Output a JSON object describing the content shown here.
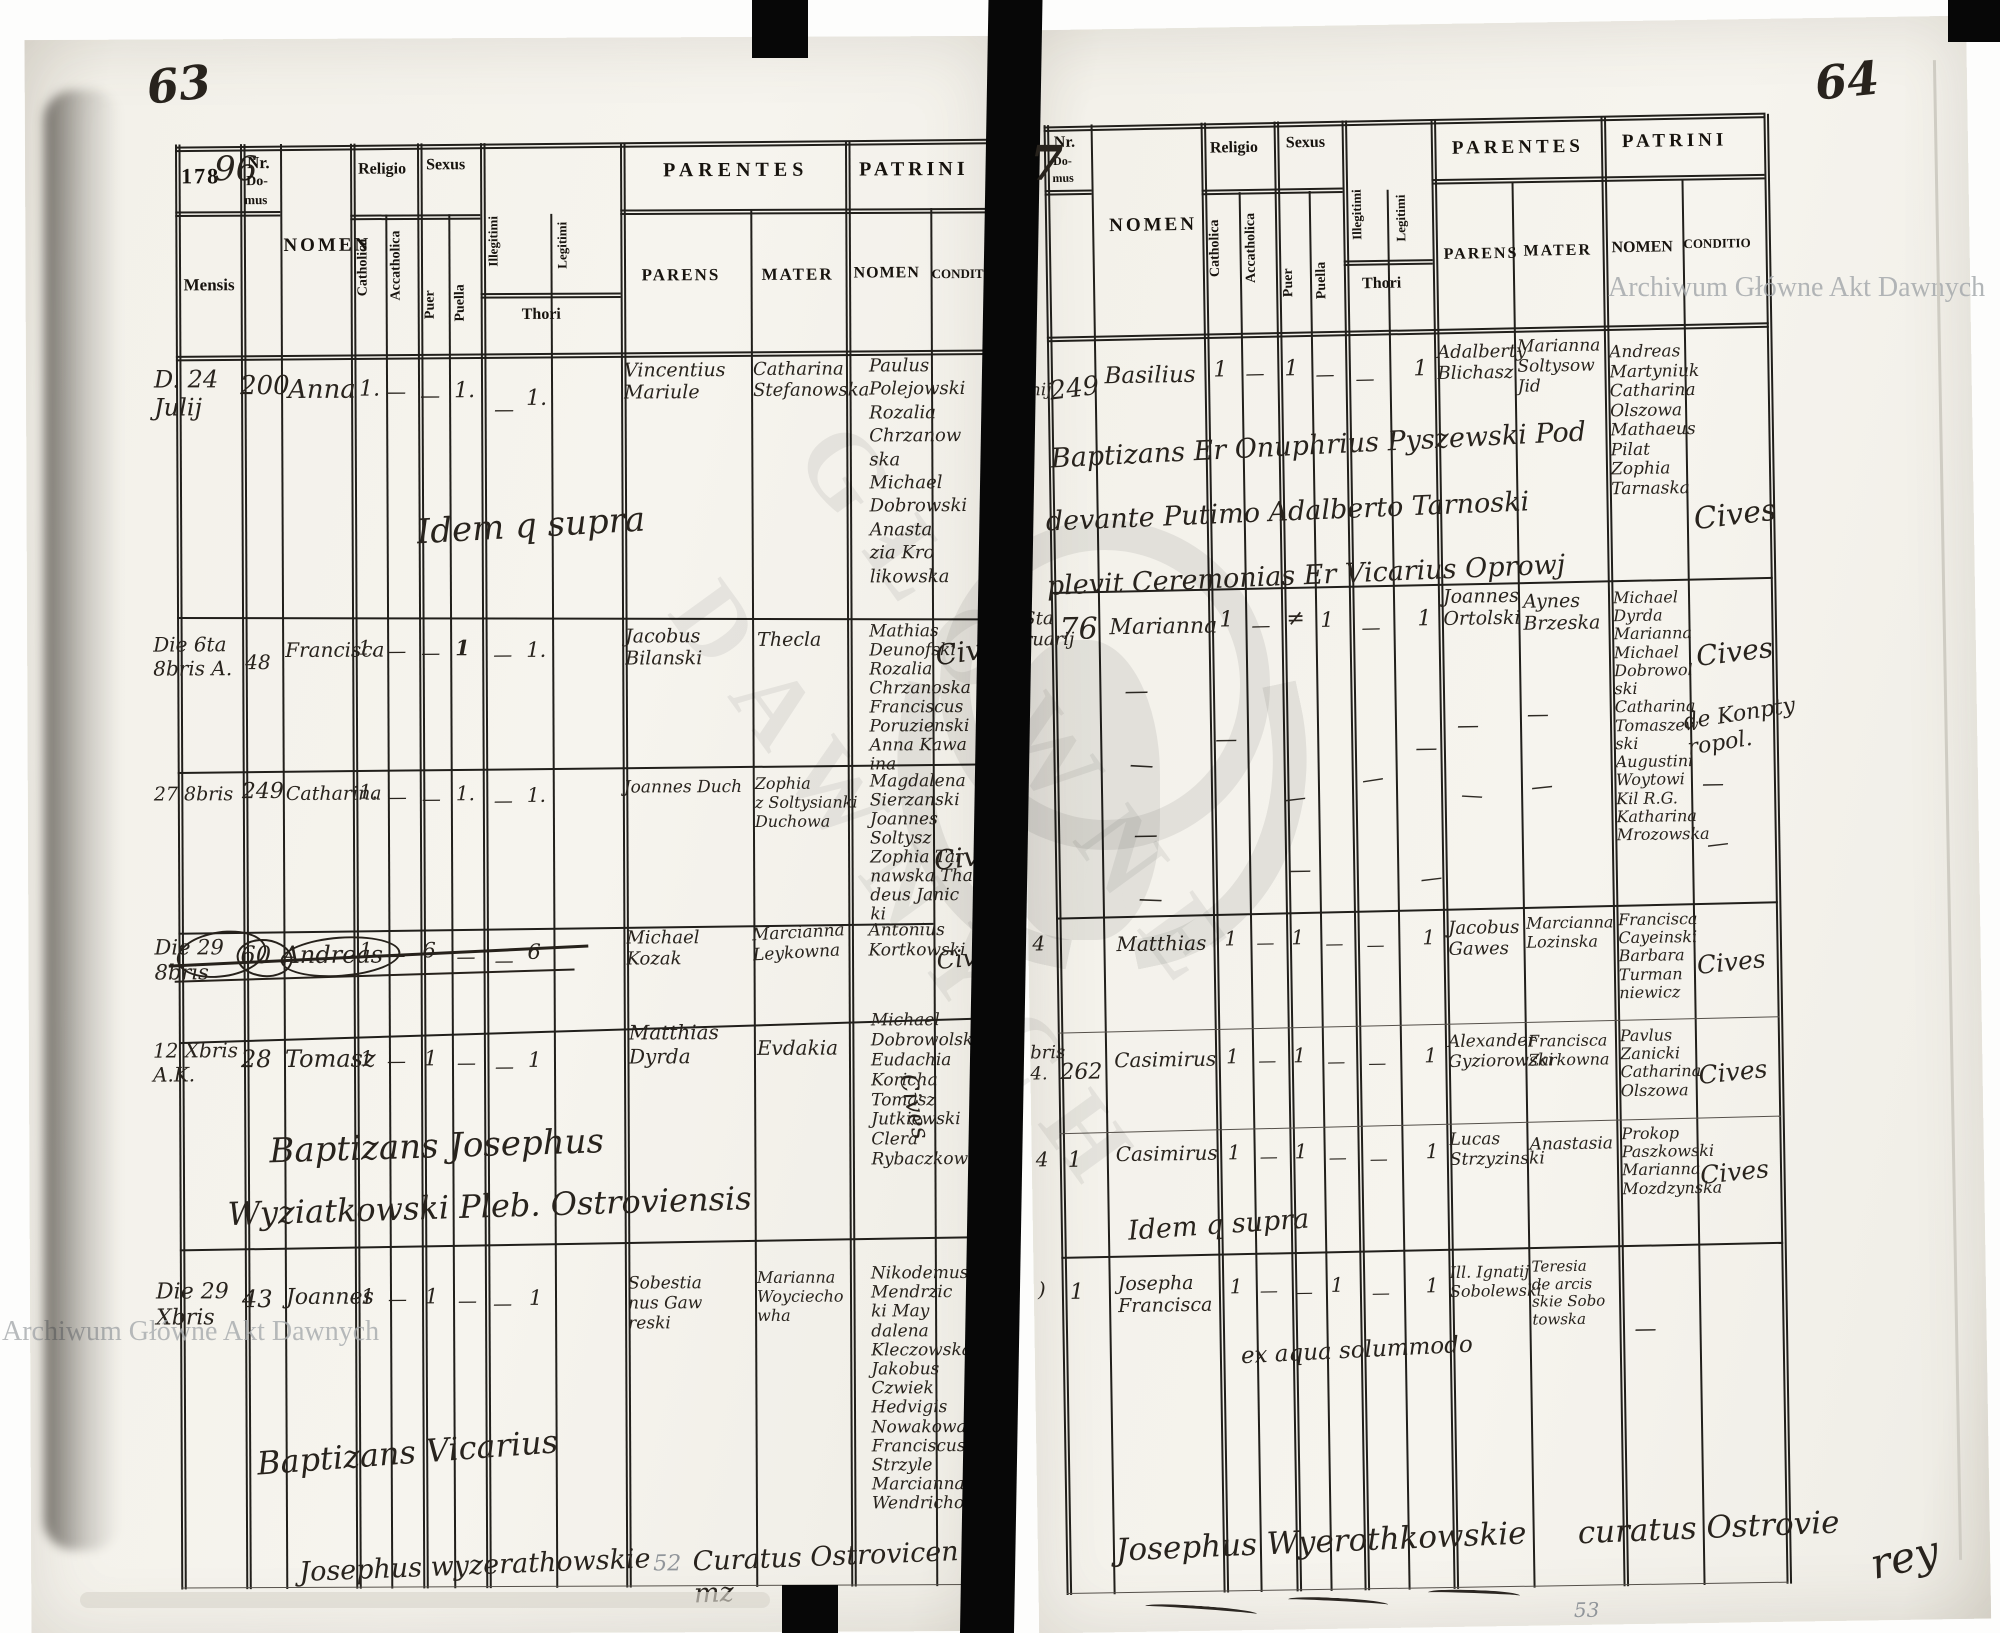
{
  "watermark": {
    "text": "Archiwum Główne Akt Dawnych",
    "diag1": "GŁÓWNE",
    "diag2": "DAWNYCH"
  },
  "ditto": "—",
  "header_labels": {
    "nr1": "Nr.",
    "nr2": "Do-",
    "nr3": "mus",
    "mensis": "Mensis",
    "nomen": "NOMEN",
    "religio": "Religio",
    "sexus": "Sexus",
    "catholica": "Catholica",
    "acatholica": "Accatholica",
    "puer": "Puer",
    "puella": "Puella",
    "illegitimi": "Illegitimi",
    "legitimi": "Legitimi",
    "thori": "Thori",
    "parentes": "PARENTES",
    "patrini": "PATRINI",
    "parens": "PARENS",
    "mater": "MATER",
    "nomen2": "NOMEN",
    "conditio": "CONDITIO"
  },
  "left_page": {
    "page_number": "63",
    "year_printed": "178",
    "year_hand": "96",
    "hand_seven": "7",
    "rows": [
      {
        "date": "D. 24\nJulij",
        "nr": "200",
        "name": "Anna",
        "cath": "1.",
        "acath": "—",
        "puer": "—",
        "puella": "1.",
        "illeg": "—",
        "leg": "1.",
        "parens": "Vincentius\nMariule",
        "mater": "Catharina\nStefanowska",
        "patrini": "Paulus\nPolejowski\nRozalia\nChrzanow\nska\nMichael\nDobrowski\nAnasta\nzia Kro\nlikowska",
        "conditio": "",
        "note": "Idem q supra"
      },
      {
        "date": "Die 6ta\n8bris A.",
        "nr": "48",
        "name": "Francisca",
        "cath": "1.",
        "acath": "—",
        "puer": "—",
        "puella": "1",
        "illeg": "—",
        "leg": "1.",
        "parens": "Jacobus\nBilanski",
        "mater": "Thecla",
        "patrini": "Mathias\nDeunofski\nRozalia\nChrzanoska\nFranciscus\nPoruzienski\nAnna Kawa\nina",
        "conditio": "Cives"
      },
      {
        "date": "27 8bris",
        "nr": "249",
        "name": "Catharina",
        "cath": "1.",
        "acath": "—",
        "puer": "—",
        "puella": "1.",
        "illeg": "—",
        "leg": "1.",
        "parens": "Joannes Duch",
        "mater": "Zophia\nz Soltysianki\nDuchowa",
        "patrini": "Magdalena\nSierzanski\nJoannes\nSoltysz\nZophia Tar\nnawska Tha\ndeus Janic\nki",
        "conditio": "Cives"
      },
      {
        "date": "Die 29\n8bris",
        "nr": "60",
        "name": "Andreas",
        "cath": "1",
        "acath": "—",
        "puer": "6",
        "puella": "—",
        "illeg": "—",
        "leg": "6",
        "parens": "Michael\nKozak",
        "mater": "Marcianna\nLeykowna",
        "patrini": "Antonius\nKortkowski",
        "conditio": "Cives"
      },
      {
        "date": "12 Xbris\nA.K.",
        "nr": "28",
        "name": "Tomasz",
        "cath": "1",
        "acath": "—",
        "puer": "1",
        "puella": "—",
        "illeg": "—",
        "leg": "1",
        "parens": "Matthias\nDyrda",
        "mater": "Evdakia",
        "patrini": "Michael\nDobrowolska\nEudachia\nKoricha\nTomasz\nJutkiewski\nClera\nRybaczkowna",
        "conditio": "Cives",
        "note1": "Baptizans Josephus",
        "note2": "Wyziatkowski Pleb. Ostroviensis"
      },
      {
        "date": "Die 29\nXbris",
        "nr": "43",
        "name": "Joannes",
        "cath": "1",
        "acath": "—",
        "puer": "1",
        "puella": "—",
        "illeg": "—",
        "leg": "1",
        "parens": "Sobestia\nnus Gaw\nreski",
        "mater": "Marianna\nWoyciecho\nwha",
        "patrini": "Nikodemus\nMendrzic\nki May\ndalena\nKleczowska\nJakobus\nCzwiek\nHedvigis\nNowakowa\nFranciscus\nStrzyle\nMarcianna\nWendrichowska",
        "conditio": "",
        "note": "Baptizans Vicarius"
      }
    ],
    "signature": {
      "part1": "Josephus wyzerathowskie",
      "part2": "Curatus Ostrovicen mz",
      "pencil": "52"
    }
  },
  "right_page": {
    "page_number": "64",
    "rows": [
      {
        "date": "te\nanij",
        "nr": "249",
        "name": "Basilius",
        "cath": "1",
        "acath": "—",
        "puer": "1",
        "puella": "—",
        "illeg": "—",
        "leg": "1",
        "parens": "Adalberty\nBlichasz",
        "mater": "Marianna\nSoltysow\nJid",
        "patrini": "Andreas\nMartyniuk\nCatharina\nOlszowa\nMathaeus\nPilat\nZophia\nTarnaska",
        "conditio": "Cives",
        "note1": "Baptizans Er Onuphrius Pyszewski Pod",
        "note2": "devante Putimo Adalberto Tarnoski",
        "note3": "plevit Ceremonias Er Vicarius Oprowj"
      },
      {
        "date": "Sta\nruarij",
        "nr": "76",
        "name": "Marianna",
        "cath": "1",
        "acath": "—",
        "puer": "≠",
        "puella": "1",
        "illeg": "—",
        "leg": "1",
        "parens": "Joannes\nOrtolski",
        "mater": "Aynes\nBrzeska",
        "patrini": "Michael\nDyrda\nMarianna\nMichael\nDobrowol\nski\nCatharina\nTomaszew\nski\nAugustini\nWoytowi\nKil R.G.\nKatharina\nMrozowska",
        "conditio": "Cives",
        "conditio2": "de Konpty\nropol."
      },
      {
        "date": "4",
        "nr": "",
        "name": "Matthias",
        "cath": "1",
        "acath": "—",
        "puer": "1",
        "puella": "—",
        "illeg": "—",
        "leg": "1",
        "parens": "Jacobus\nGawes",
        "mater": "Marcianna\nLozinska",
        "patrini": "Francisca\nCayeinski\nBarbara\nTurman\nniewicz",
        "conditio": "Cives"
      },
      {
        "date": "bris\n4.",
        "nr": "262",
        "name": "Casimirus",
        "cath": "1",
        "acath": "—",
        "puer": "1",
        "puella": "—",
        "illeg": "—",
        "leg": "1",
        "parens": "Alexander\nGyziorowski",
        "mater": "Francisca\nZarkowna",
        "patrini": "Pavlus\nZanicki\nCatharina\nOlszowa",
        "conditio": "Cives"
      },
      {
        "date": "4",
        "nr": "1",
        "name": "Casimirus",
        "cath": "1",
        "acath": "—",
        "puer": "1",
        "puella": "—",
        "illeg": "—",
        "leg": "1",
        "parens": "Lucas\nStrzyzinski",
        "mater": "Anastasia",
        "patrini": "Prokop\nPaszkowski\nMarianna\nMozdzynska",
        "conditio": "Cives",
        "note": "Idem q supra"
      },
      {
        "date": ")",
        "nr": "1",
        "name": "Josepha\nFrancisca",
        "cath": "1",
        "acath": "—",
        "puer": "—",
        "puella": "1",
        "illeg": "—",
        "leg": "1",
        "parens": "Ill. Ignatij\nSobolewski",
        "mater": "Teresia\nde arcis\nskie Sobo\ntowska",
        "patrini": "—",
        "conditio": "",
        "note": "ex aqua solummodo"
      }
    ],
    "signature": {
      "part1": "Josephus Wyerothkowskie",
      "part2": "curatus Ostrovie",
      "part3": "rey",
      "pencil": "53"
    }
  }
}
